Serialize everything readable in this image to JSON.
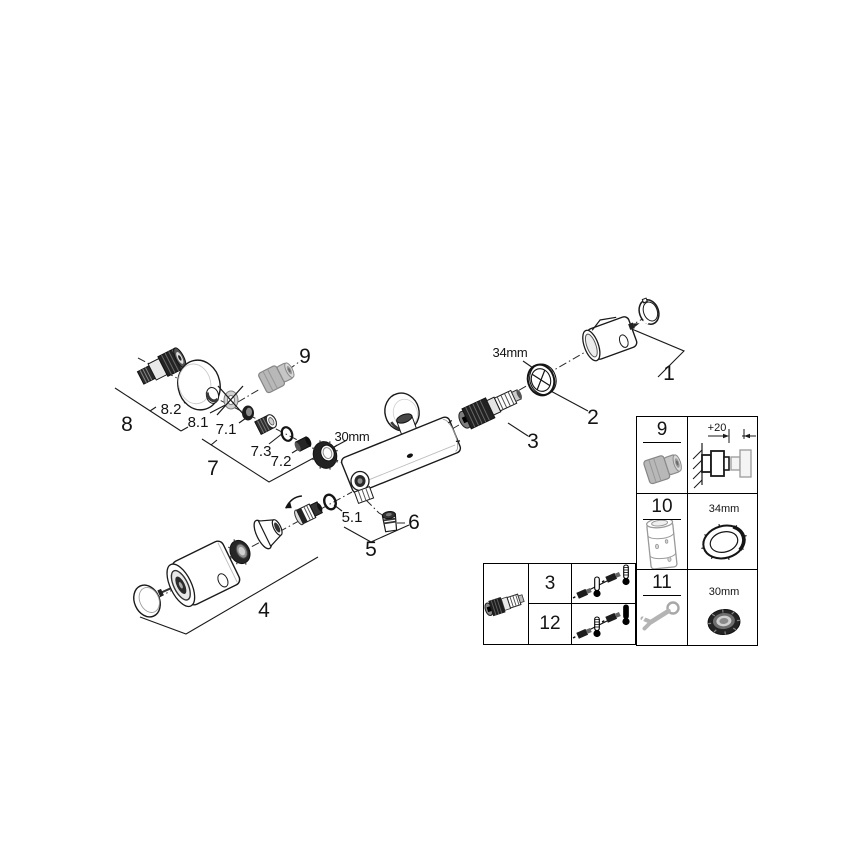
{
  "colors": {
    "background": "#ffffff",
    "line_art": "#1a1a1a",
    "dark_part": "#222222",
    "grey_part": "#b5b5b5",
    "grey_tool": "#a8a8a8"
  },
  "diagram": {
    "part_labels": {
      "p1": "1",
      "p2": "2",
      "p3": "3",
      "p4": "4",
      "p5": "5",
      "p5_1": "5.1",
      "p6": "6",
      "p7": "7",
      "p7_1": "7.1",
      "p7_2": "7.2",
      "p7_3": "7.3",
      "p8": "8",
      "p8_1": "8.1",
      "p8_2": "8.2",
      "p9": "9"
    },
    "dimensions": {
      "nut_main": "30mm",
      "ring_main": "34mm"
    }
  },
  "side_table": {
    "rows": [
      {
        "ref": "9",
        "detail": "+20"
      },
      {
        "ref": "10",
        "detail": "34mm"
      },
      {
        "ref": "11",
        "detail": "30mm"
      }
    ]
  },
  "bottom_table": {
    "rows": [
      {
        "ref": "3"
      },
      {
        "ref": "12"
      }
    ]
  },
  "icons": {
    "wrench": "open-end-wrench",
    "thermometer": "mercury-thermometer",
    "flow_arrow": "curved-direction-arrow",
    "crossed_out": "x-cross-over-part"
  }
}
